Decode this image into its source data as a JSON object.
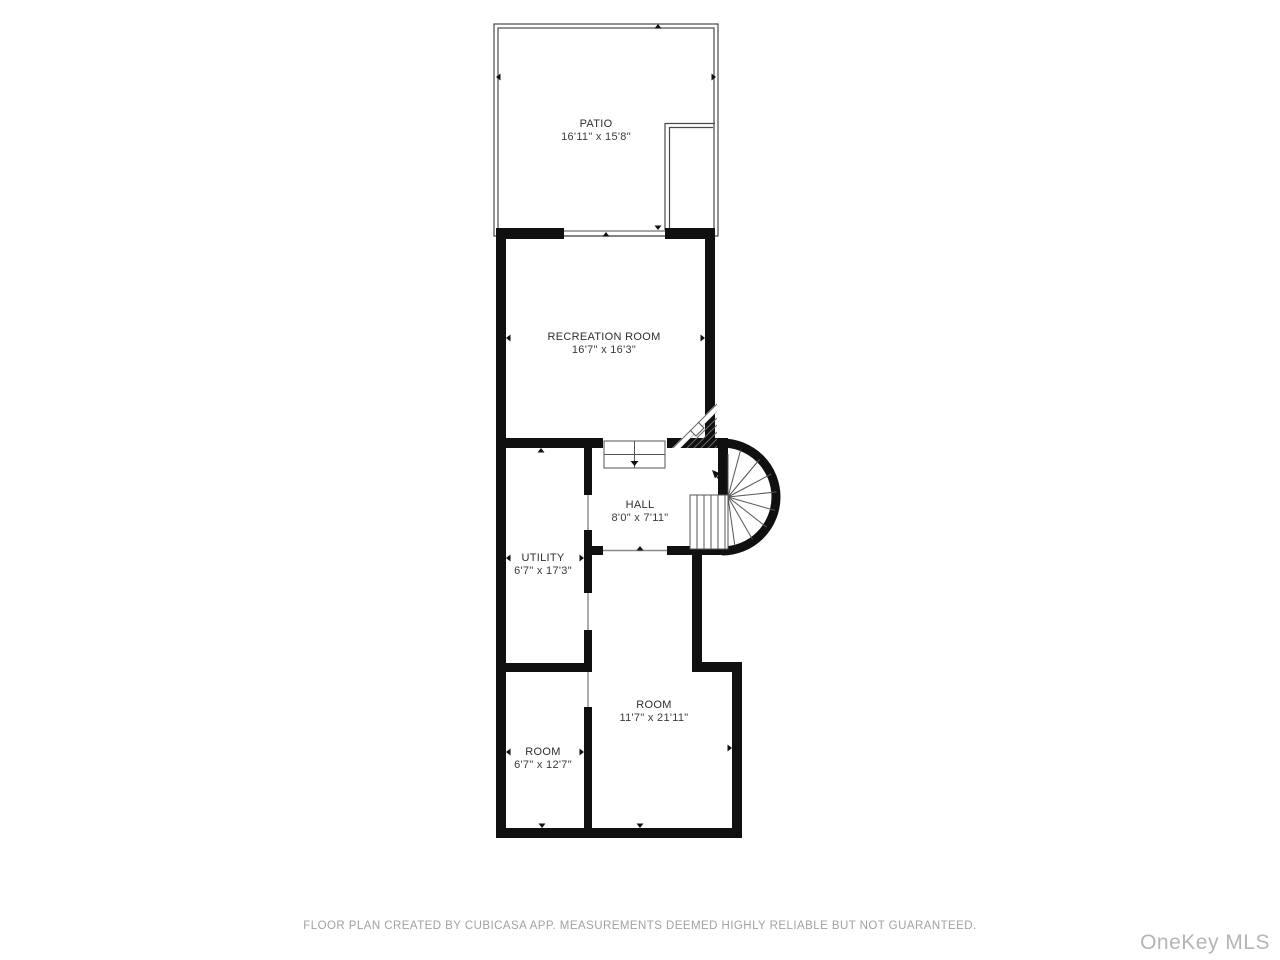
{
  "plan": {
    "rooms": [
      {
        "id": "patio",
        "name": "PATIO",
        "dims": "16'11\" x 15'8\""
      },
      {
        "id": "recreation-room",
        "name": "RECREATION ROOM",
        "dims": "16'7\" x 16'3\""
      },
      {
        "id": "hall",
        "name": "HALL",
        "dims": "8'0\" x 7'11\""
      },
      {
        "id": "utility",
        "name": "UTILITY",
        "dims": "6'7\" x 17'3\""
      },
      {
        "id": "room-large",
        "name": "ROOM",
        "dims": "11'7\" x 21'11\""
      },
      {
        "id": "room-small",
        "name": "ROOM",
        "dims": "6'7\" x 12'7\""
      }
    ]
  },
  "footer": {
    "disclaimer": "FLOOR PLAN CREATED BY CUBICASA APP. MEASUREMENTS DEEMED HIGHLY RELIABLE BUT NOT GUARANTEED."
  },
  "watermark": {
    "text": "OneKey MLS"
  },
  "colors": {
    "wall": "#101010",
    "thin_outline": "#4a4a4a",
    "stair_line": "#555555",
    "opening_line": "#8a8a8a",
    "label_text": "#2e2e2e",
    "disclaimer_text": "#a2a2a2",
    "watermark_text": "#b5b5b5",
    "background": "#ffffff"
  }
}
